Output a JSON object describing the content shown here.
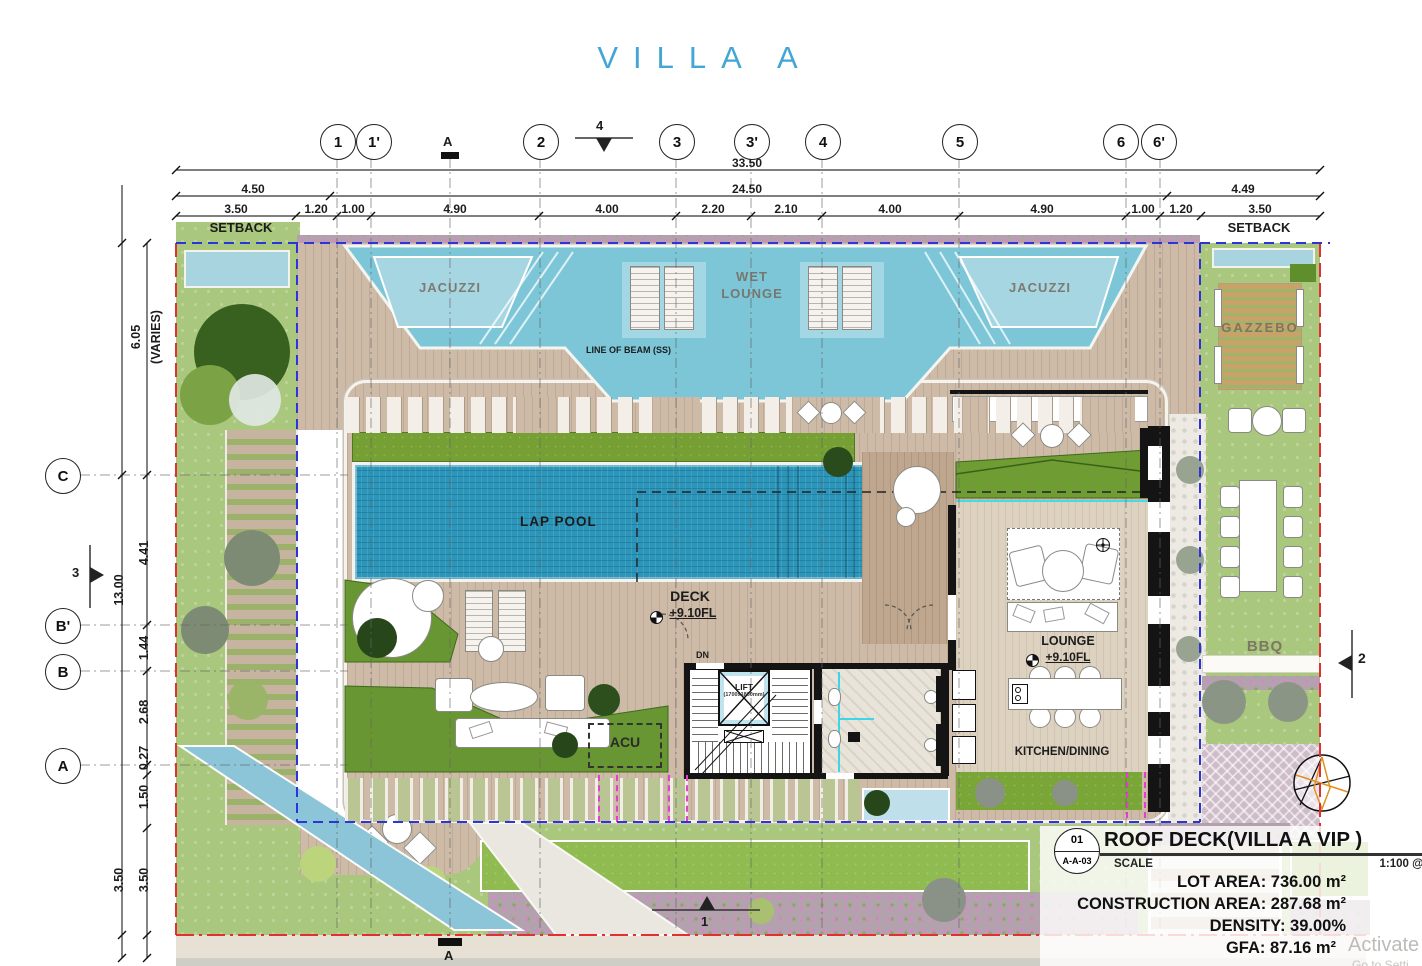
{
  "title": "VILLA A",
  "grid": {
    "top": [
      "1",
      "1'",
      "2",
      "3",
      "3'",
      "4",
      "5",
      "6",
      "6'"
    ],
    "left": [
      "C",
      "B'",
      "B",
      "A"
    ]
  },
  "sections": {
    "top": "4",
    "left": "3",
    "right": "2",
    "bottom": "1"
  },
  "datum": {
    "top": "A",
    "bottom": "A"
  },
  "dims": {
    "total": "33.50",
    "inner": "24.50",
    "left_end": "4.50",
    "right_end": "4.49",
    "segments": [
      "3.50",
      "1.20",
      "1.00",
      "4.90",
      "4.00",
      "2.20",
      "2.10",
      "4.00",
      "4.90",
      "1.00",
      "1.20",
      "3.50"
    ],
    "setback_left": "SETBACK",
    "setback_right": "SETBACK",
    "v_top": "6.05",
    "v_top_note": "(VARIES)",
    "v_total": "13.00",
    "v_segments": [
      "4.41",
      "1.44",
      "2.68",
      "0.27",
      "1.50",
      "3.50"
    ],
    "v_outer": "3.50"
  },
  "rooms": {
    "jacuzzi_left": "JACUZZI",
    "jacuzzi_right": "JACUZZI",
    "wet_lounge": "WET LOUNGE",
    "line_of_beam": "LINE OF BEAM (SS)",
    "lap_pool": "LAP POOL",
    "deck": "DECK",
    "deck_level": "+9.10FL",
    "lounge": "LOUNGE",
    "lounge_level": "+9.10FL",
    "kitchen_dining": "KITCHEN/DINING",
    "acu": "ACU",
    "dn": "DN",
    "lift": "LIFT",
    "lift_size": "(1700x1800mm)",
    "gazzebo": "GAZZEBO",
    "bbq": "BBQ"
  },
  "title_block": {
    "sheet_no": "01",
    "sheet_ref": "A-A-03",
    "title": "ROOF DECK(VILLA A VIP )",
    "scale_label": "SCALE",
    "scale_value": "1:100 @A3",
    "stats": [
      "LOT AREA: 736.00 m²",
      "CONSTRUCTION AREA: 287.68 m²",
      "DENSITY: 39.00%",
      "GFA: 87.16 m²"
    ]
  },
  "watermark": {
    "line1": "Activate",
    "line2": "Go to Setti"
  },
  "colors": {
    "title_blue": "#43a6d5",
    "water": "#7cc6d8",
    "lap_pool": "#2b96ba",
    "property_line": "#e03030",
    "setback_line": "#2b35d8"
  }
}
